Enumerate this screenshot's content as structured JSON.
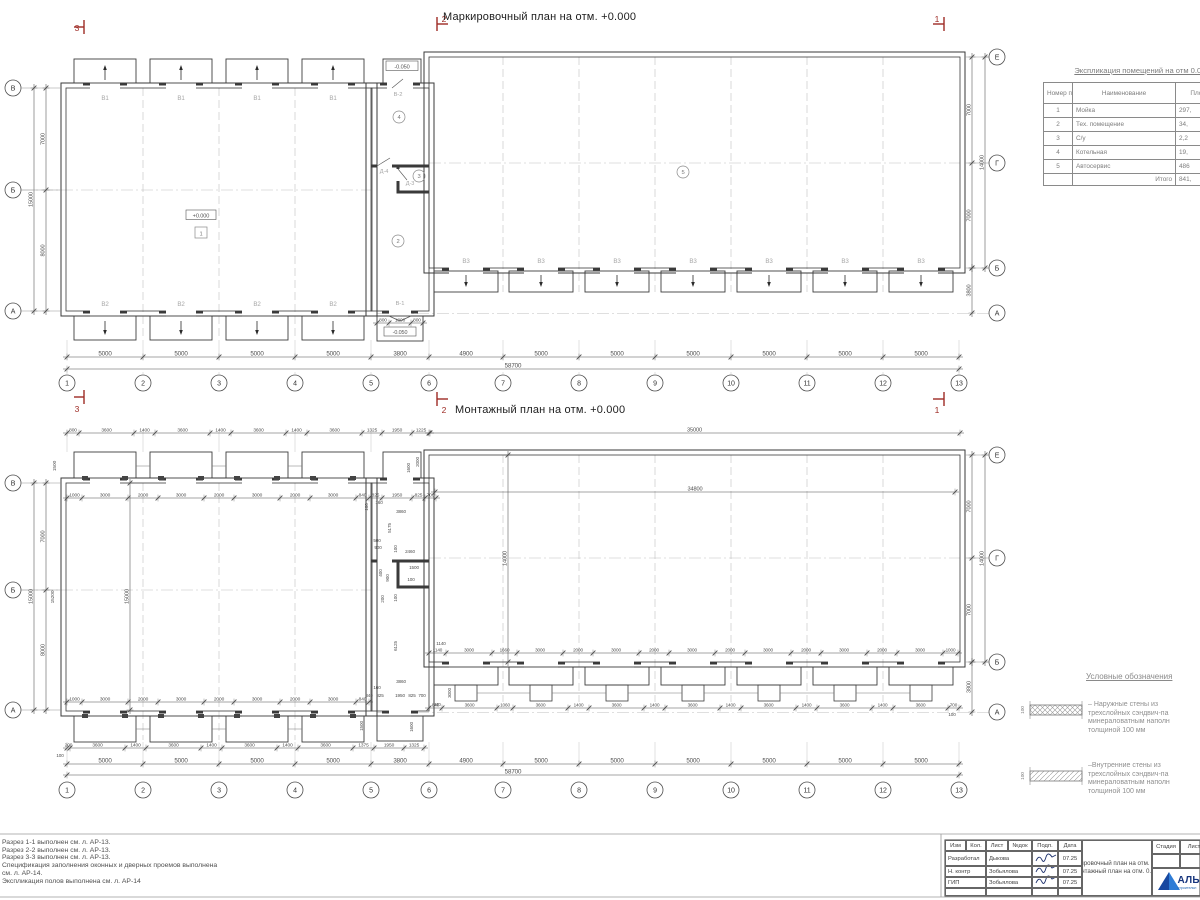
{
  "colors": {
    "line": "#3d3d3d",
    "wall": "#3a3a3a",
    "dim": "#4d4d4d",
    "label": "#a6a6a6",
    "grid": "#bfbfbf",
    "red": "#9e2b25",
    "blue": "#1e63b0",
    "blue_dark": "#17357d",
    "ink": "#1b2f6b"
  },
  "plan_top": {
    "title": "Маркировочный план на отм. +0.000",
    "cols": [
      "1",
      "2",
      "3",
      "4",
      "5",
      "6",
      "7",
      "8",
      "9",
      "10",
      "11",
      "12",
      "13"
    ],
    "rows_left": [
      "В",
      "Б",
      "А"
    ],
    "rows_right": [
      "Е",
      "Г",
      "Б",
      "А"
    ],
    "dims_bottom": [
      "5000",
      "5000",
      "5000",
      "5000",
      "3800",
      "4900",
      "5000",
      "5000",
      "5000",
      "5000",
      "5000",
      "5000"
    ],
    "dim_total": "58700",
    "dims_left": [
      "7000",
      "8000"
    ],
    "dim_left_total": "15000",
    "dims_right": [
      "7000",
      "7000"
    ],
    "dim_right_total": "14000",
    "dim_right_lower": "3800",
    "gate_top_label": "В1",
    "gate_bottom_label": "В2",
    "gate_right_label": "В3",
    "door_v2": "В-2",
    "door_d4": "Д-4",
    "door_d3": "Д-3",
    "door_v1": "В-1",
    "level_main": "+0.000",
    "level_entry": "-0.050",
    "rooms": [
      "1",
      "2",
      "3",
      "4",
      "5"
    ],
    "door_dims": [
      "800",
      "1800",
      "800"
    ],
    "sections": {
      "left": "3",
      "mid": "2",
      "right": "1"
    }
  },
  "plan_bottom": {
    "title": "Монтажный план на отм. +0.000",
    "cols": [
      "1",
      "2",
      "3",
      "4",
      "5",
      "6",
      "7",
      "8",
      "9",
      "10",
      "11",
      "12",
      "13"
    ],
    "rows_left": [
      "В",
      "Б",
      "А"
    ],
    "rows_right": [
      "Е",
      "Г",
      "Б",
      "А"
    ],
    "dims_top_row1": [
      "800",
      "3600",
      "1400",
      "3600",
      "1400",
      "3600",
      "1400",
      "3600",
      "1325",
      "1950",
      "1225"
    ],
    "dims_top_row2": [
      "1000",
      "3000",
      "2000",
      "3000",
      "2000",
      "3000",
      "2000",
      "3000",
      "840",
      "825",
      "1950",
      "825",
      "700"
    ],
    "dim_right_top": "35000",
    "dim_right_inner": "34800",
    "dim_inner_height": "14000",
    "dim_left_inner": "15000",
    "dims_rb_row1": [
      "1140",
      "3000",
      "1660",
      "3000",
      "2000",
      "3000",
      "2000",
      "3000",
      "2000",
      "3000",
      "2000",
      "3000",
      "2000",
      "3000",
      "1000"
    ],
    "dims_rb_row2": [
      "840",
      "3600",
      "1060",
      "3600",
      "1400",
      "3600",
      "1400",
      "3600",
      "1400",
      "3600",
      "1400",
      "3600",
      "1400",
      "3600",
      "700"
    ],
    "dims_lb_row1": [
      "1000",
      "3000",
      "2000",
      "3000",
      "2000",
      "3000",
      "2000",
      "3000",
      "840"
    ],
    "dims_lb_row2": [
      "200",
      "3600",
      "1400",
      "3600",
      "1400",
      "3600",
      "1400",
      "3600",
      "1375",
      "1950",
      "1325"
    ],
    "dims_bottom": [
      "5000",
      "5000",
      "5000",
      "5000",
      "3800",
      "4900",
      "5000",
      "5000",
      "5000",
      "5000",
      "5000",
      "5000"
    ],
    "dim_total": "58700",
    "dims_left": [
      "7000",
      "8000"
    ],
    "dim_left_total": "15000",
    "dims_left_extra": [
      "1500",
      "15200"
    ],
    "dims_right": [
      "7000",
      "7000"
    ],
    "dim_right_total": "14000",
    "dim_right_lower": "3800",
    "connector_dims": [
      "100",
      "160",
      "3860",
      "5175",
      "500",
      "900",
      "100",
      "2460",
      "400",
      "900",
      "1500",
      "100",
      "200",
      "100",
      "6125",
      "1140",
      "3860",
      "160",
      "840",
      "825",
      "1950",
      "825",
      "700",
      "840",
      "3000",
      "1500",
      "1600",
      "1600",
      "2000"
    ],
    "corner_notes": [
      "100",
      "100"
    ],
    "sections": {
      "mid": "2",
      "right": "1"
    }
  },
  "explication": {
    "title": "Экспликация помещений на отм 0.000",
    "headers": [
      "Номер помещ.",
      "Наименование",
      "Площ"
    ],
    "rows": [
      [
        "1",
        "Мойка",
        "297,"
      ],
      [
        "2",
        "Тех. помещение",
        "34,"
      ],
      [
        "3",
        "С/у",
        "2,2"
      ],
      [
        "4",
        "Котельная",
        "19,"
      ],
      [
        "5",
        "Автосервис",
        "486"
      ]
    ],
    "total_label": "Итого",
    "total_value": "841,"
  },
  "legend": {
    "title": "Условные обозначения",
    "items": [
      {
        "dim": "100",
        "lines": [
          "– Наружные стены из",
          "трехслойных сэндвич-па",
          "минераловатным наполн",
          "толщиной 100 мм"
        ]
      },
      {
        "dim": "100",
        "lines": [
          "–Внутренние стены из",
          "трехслойных сэндвич-па",
          "минераловатным наполн",
          "толщиной 100 мм"
        ]
      }
    ]
  },
  "notes": [
    "Разрез 1-1 выполнен см. л. АР-13.",
    "Разрез 2-2 выполнен см. л. АР-13.",
    "Разрез 3-3 выполнен см. л. АР-13.",
    "Спецификация заполнения оконных и дверных проемов выполнена",
    "см. л. АР-14.",
    "Экспликация полов выполнена см. л. АР-14"
  ],
  "title_block": {
    "header_cols": [
      "Изм",
      "Кол.",
      "Лист",
      "№док",
      "Подп.",
      "Дата"
    ],
    "rows": [
      {
        "role": "Разработал",
        "name": "Дыкова",
        "date": "07.25"
      },
      {
        "role": "Н. контр",
        "name": "Зобьялова",
        "date": "07.25"
      },
      {
        "role": "ГИП",
        "name": "Зобьялова",
        "date": "07.25"
      }
    ],
    "doc_title_lines": [
      "Маркировочный план на отм. 0.000.",
      "Монтажный план на отм. 0.000"
    ],
    "stage_label": "Стадия",
    "sheet_label": "Лист",
    "logo_text": "АЛЬЯ",
    "logo_sub": "строительн"
  }
}
